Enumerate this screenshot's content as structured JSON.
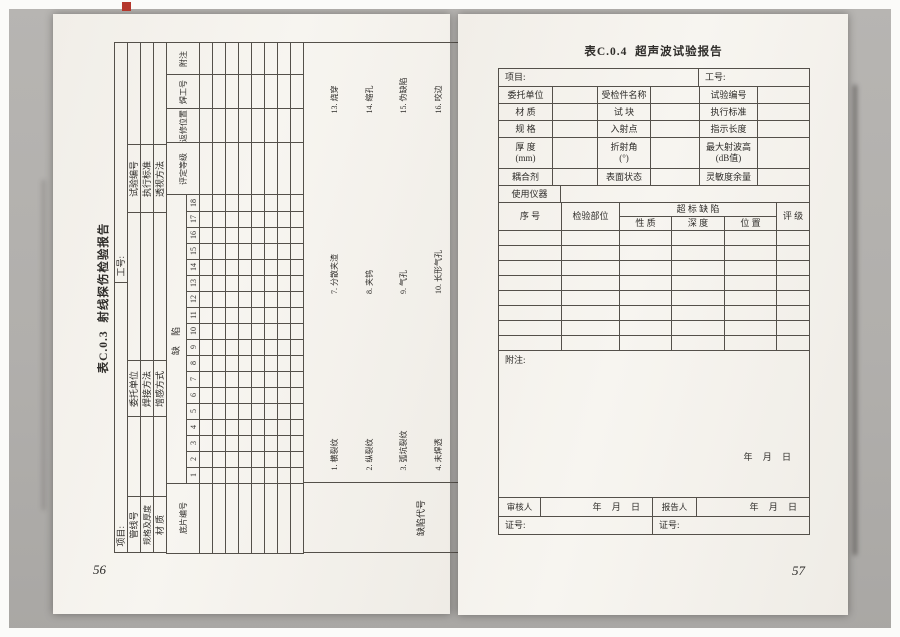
{
  "colors": {
    "paper": "#f5f3ee",
    "background": "#b1afac",
    "ink": "#2f2d2a",
    "red_mark": "#b5372c",
    "line": "#54504a"
  },
  "pages": {
    "left": {
      "page_number": "56",
      "title": "表C.0.3  射线探伤检验报告",
      "info_row1": {
        "project_label": "项目:",
        "job_label": "工号:"
      },
      "info_rows": [
        [
          "管线号",
          "",
          "委托单位",
          "",
          "试验编号",
          ""
        ],
        [
          "规格及厚度",
          "",
          "焊接方法",
          "",
          "执行标准",
          ""
        ],
        [
          "材 质",
          "",
          "增感方式",
          "",
          "透视方法",
          ""
        ]
      ],
      "grid": {
        "film_no_label": "底片编号",
        "defect_label": "缺  陷",
        "numbers": [
          "1",
          "2",
          "3",
          "4",
          "5",
          "6",
          "7",
          "8",
          "9",
          "10",
          "11",
          "12",
          "13",
          "14",
          "15",
          "16",
          "17",
          "18"
        ],
        "right_headers": [
          "评定等级",
          "返修位置",
          "焊工号",
          "附注"
        ]
      },
      "legend": {
        "label": "缺陷代号",
        "groups": [
          [
            "1. 横裂纹",
            "2. 纵裂纹",
            "3. 弧坑裂纹",
            "4. 未焊透",
            "5. 未熔合",
            "6. 条状夹渣"
          ],
          [
            "7. 分散夹渣",
            "8. 夹钨",
            "9. 气孔",
            "10. 长形气孔",
            "11. 过烧透",
            "12. 凹陷"
          ],
          [
            "13. 烧穿",
            "14. 缩孔",
            "15. 伪缺陷",
            "16. 咬边",
            "17. 错口",
            "18. 表面沟槽"
          ]
        ]
      },
      "signature": {
        "reviewer_label": "审核人:",
        "date1": "年 月 日",
        "film_eval_label": "评片:",
        "date2": "年 月 日",
        "darkroom_label": "暗房处理:",
        "date3": "年 月 日",
        "shooting_label": "拍片:",
        "date4": "年 月 日"
      }
    },
    "right": {
      "page_number": "57",
      "title": "表C.0.4  超声波试验报告",
      "info_row1": {
        "project_label": "项目:",
        "job_label": "工号:"
      },
      "info_rows": [
        [
          "委托单位",
          "",
          "受检件名称",
          "",
          "试验编号",
          ""
        ],
        [
          "材 质",
          "",
          "试 块",
          "",
          "执行标准",
          ""
        ],
        [
          "规 格",
          "",
          "入射点",
          "",
          "指示长度",
          ""
        ],
        [
          "厚 度\n(mm)",
          "",
          "折射角\n(°)",
          "",
          "最大射波高\n(dB值)",
          ""
        ],
        [
          "耦合剂",
          "",
          "表面状态",
          "",
          "灵敏度余量",
          ""
        ]
      ],
      "instrument_label": "使用仪器",
      "defect_header": {
        "seq": "序  号",
        "part": "检验部位",
        "over": "超 标 缺 陷",
        "sub": [
          "性  质",
          "深  度",
          "位  置"
        ],
        "grade": "评  级"
      },
      "notes": {
        "label": "附注:",
        "date": "年 月 日"
      },
      "sign_row": {
        "reviewer": "审核人",
        "date1": "年 月 日",
        "reporter": "报告人",
        "date2": "年 月 日"
      },
      "cert_row": {
        "left": "证号:",
        "right": "证号:"
      }
    }
  }
}
